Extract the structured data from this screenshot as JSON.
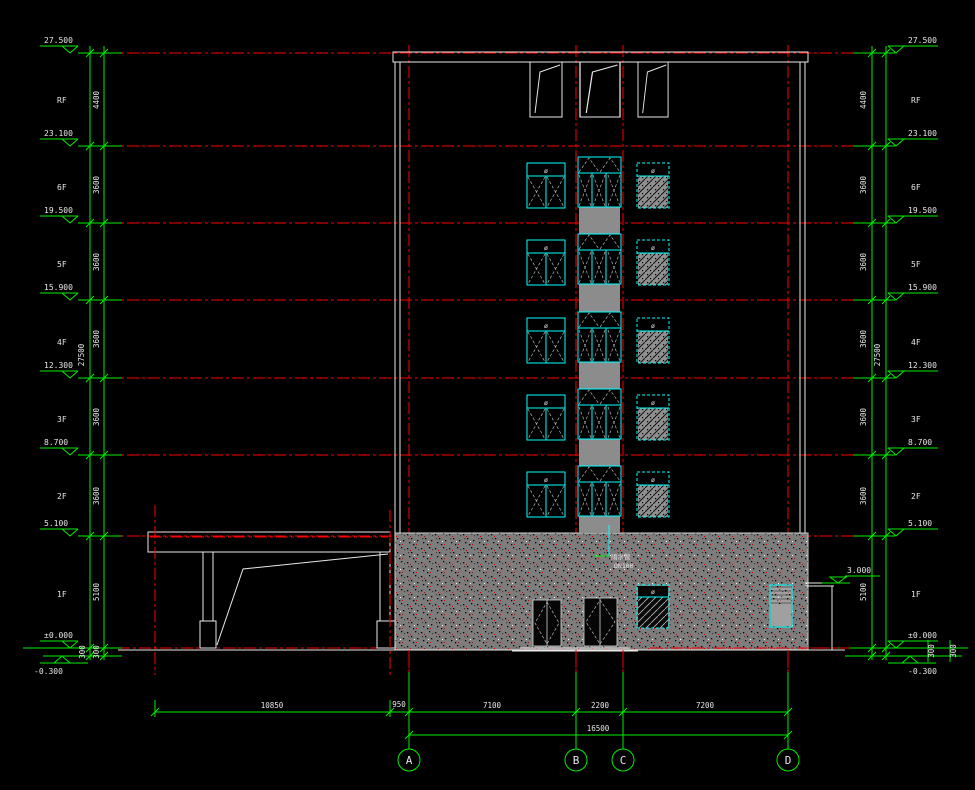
{
  "drawing": {
    "type": "building-elevation-cad-drawing",
    "elevations": [
      "27.500",
      "23.100",
      "19.500",
      "15.900",
      "12.300",
      "8.700",
      "5.100",
      "±0.000",
      "-0.300"
    ],
    "floor_labels": [
      "RF",
      "6F",
      "5F",
      "4F",
      "3F",
      "2F",
      "1F"
    ],
    "vertical_dims": [
      "4400",
      "3600",
      "3600",
      "3600",
      "3600",
      "3600",
      "5100",
      "300"
    ],
    "vertical_total": "27500",
    "small_dims": [
      "300",
      "300"
    ],
    "bottom_dims": [
      "10850",
      "950",
      "7100",
      "2200",
      "7200"
    ],
    "bottom_total": "16500",
    "grid_bubbles": [
      "A",
      "B",
      "C",
      "D"
    ],
    "canopy_level": "3.000",
    "window_tag": "ø",
    "pipe_note_1": "雨水管",
    "pipe_note_2": "DN100",
    "colors": {
      "background": "#000000",
      "dimension_green": "#00ee00",
      "grid_red": "#ff0000",
      "window_cyan": "#00ffff",
      "outline_white": "#e8e8e8",
      "stone_gray": "#7d7d7d"
    }
  }
}
